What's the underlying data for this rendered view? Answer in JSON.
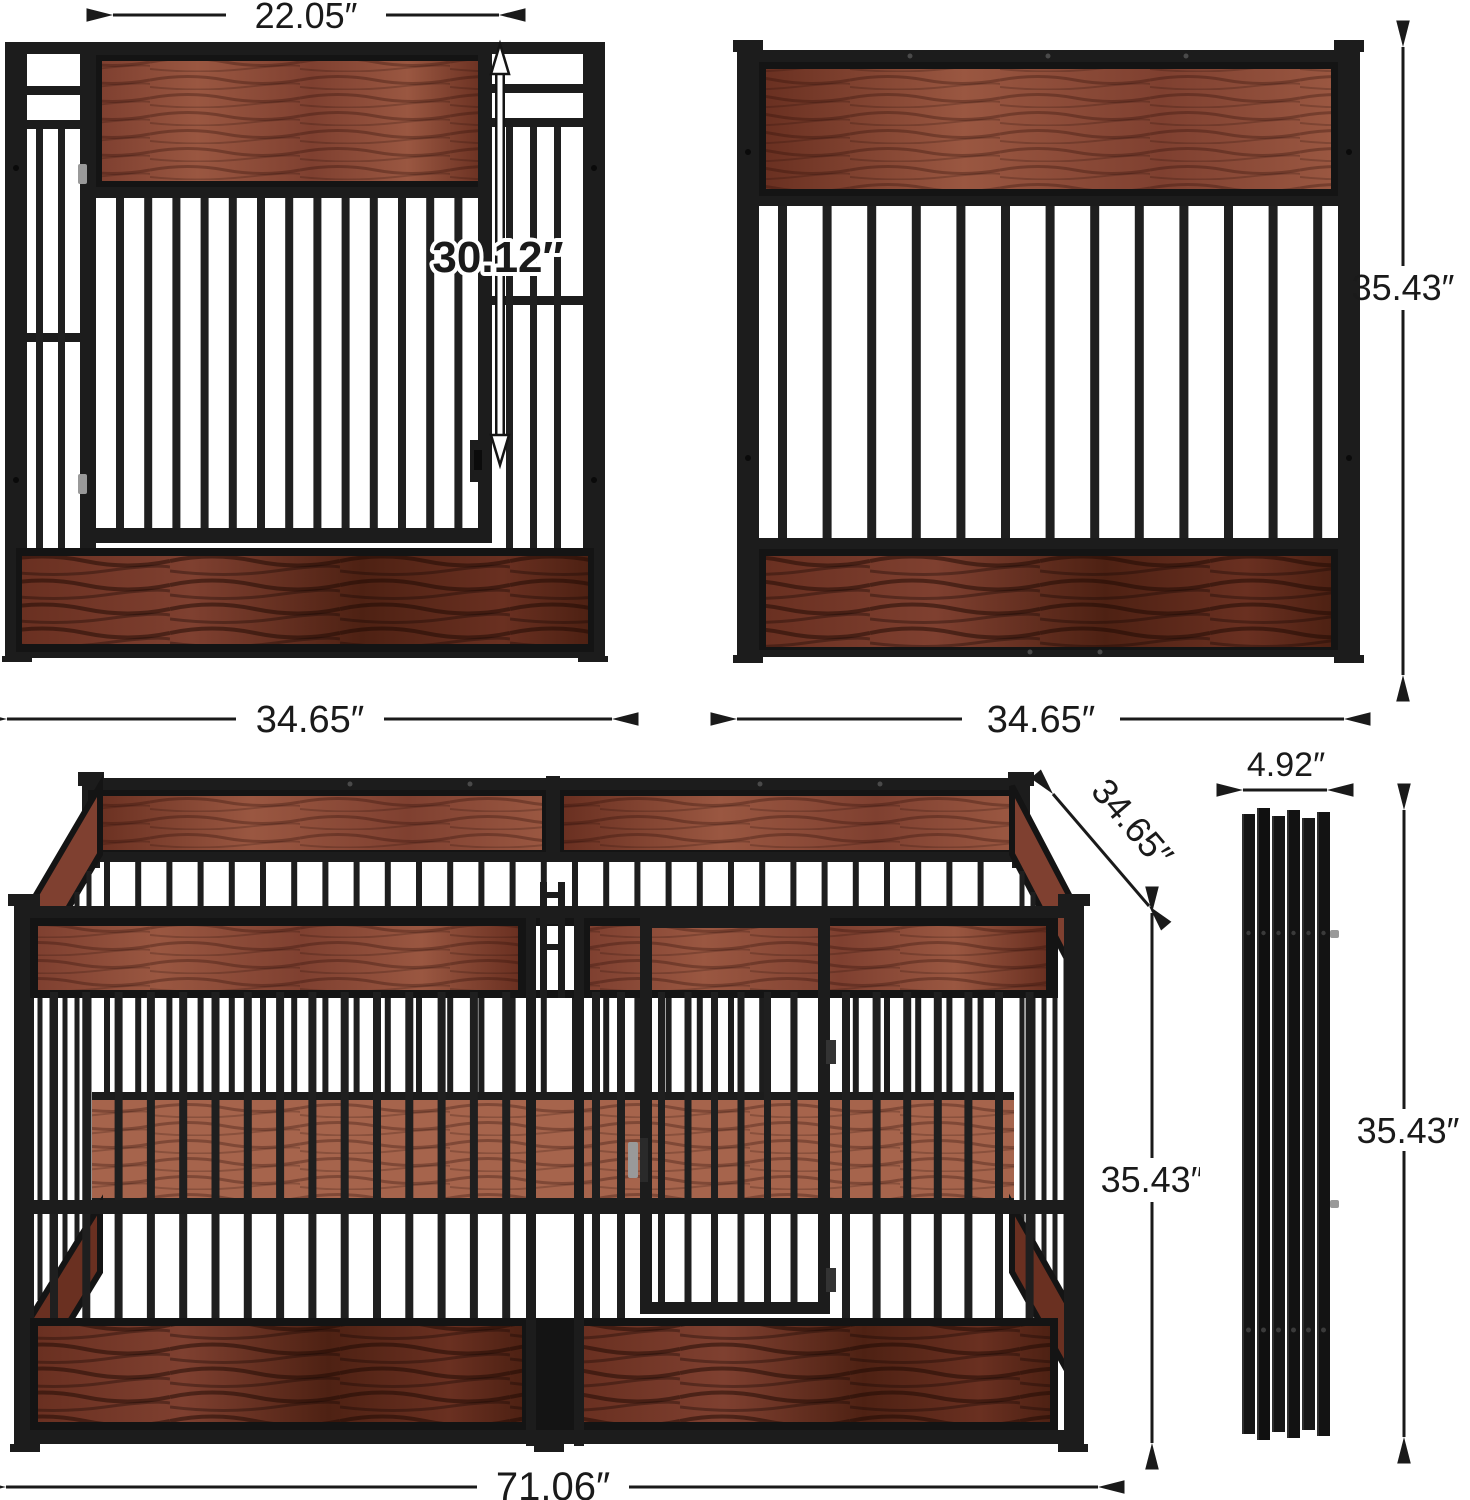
{
  "colors": {
    "background": "#ffffff",
    "metal": "#1c1c1c",
    "frame-dark": "#141414",
    "bar-color": "#1f1f1f",
    "wood-light": "#9a5741",
    "wood-mid": "#7f4030",
    "wood-dark": "#6a3021",
    "wood-deep": "#4e2113",
    "wood-seen": "#a15c42",
    "silver": "#999999",
    "dim-line": "#1a1a1a"
  },
  "dims": {
    "door_width": {
      "label": "22.05″"
    },
    "door_height": {
      "label": "30.12″"
    },
    "side_panel_height": {
      "label": "35.43″"
    },
    "front_panel_width": {
      "label": "34.65″"
    },
    "side_panel_width": {
      "label": "34.65″"
    },
    "pen_depth": {
      "label": "34.65″"
    },
    "folded_width": {
      "label": "4.92″"
    },
    "pen_height": {
      "label": "35.43″"
    },
    "folded_height": {
      "label": "35.43″"
    },
    "pen_length": {
      "label": "71.06″"
    }
  }
}
